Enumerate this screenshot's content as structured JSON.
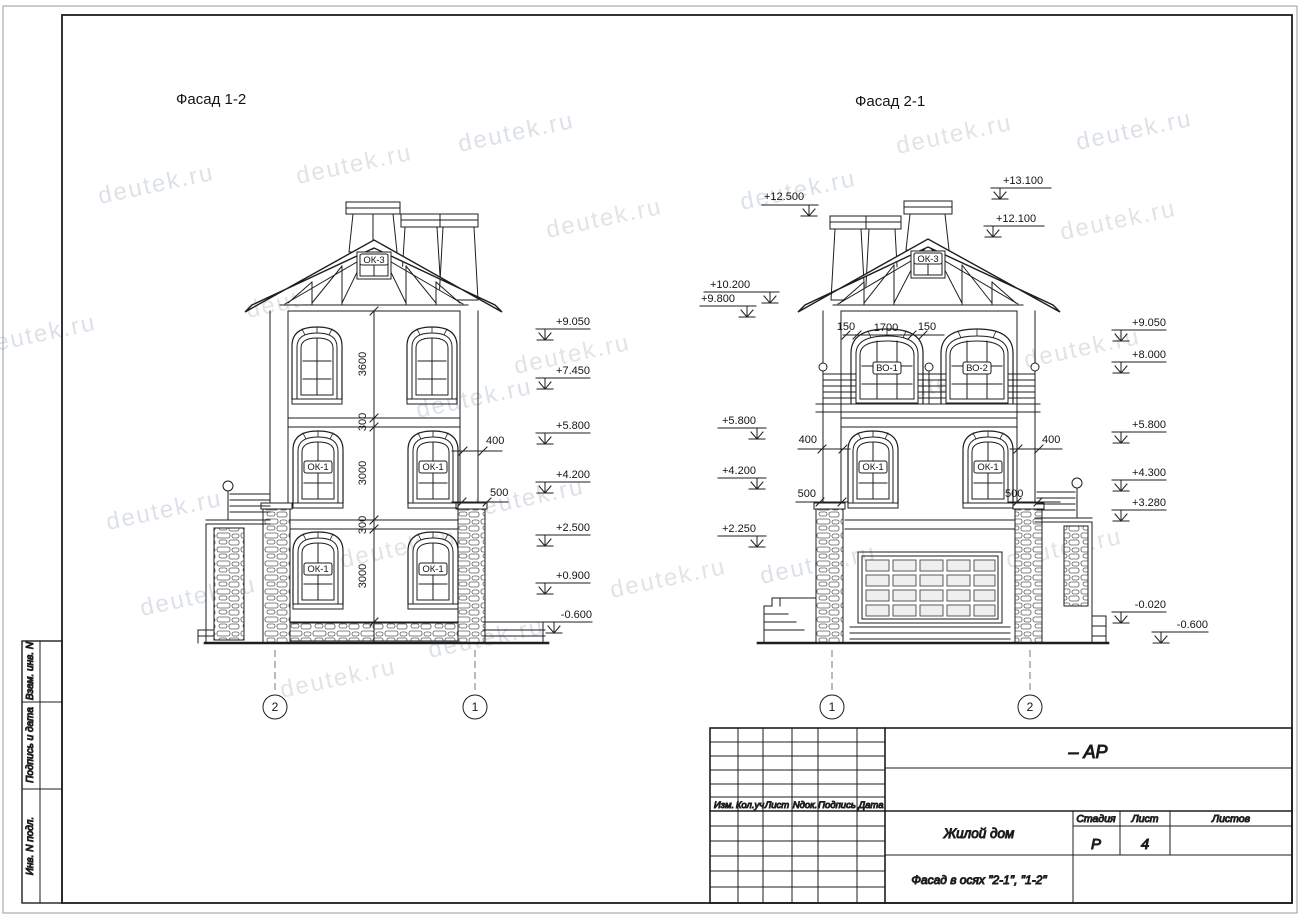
{
  "watermark": {
    "text": "deutek.ru"
  },
  "facades": {
    "left": {
      "title": "Фасад 1-2",
      "gable_window_label": "ОК-3",
      "window_labels": {
        "floor1_left": "ОК-1",
        "floor1_right": "ОК-1",
        "ground_left": "ОК-1",
        "ground_right": "ОК-1"
      },
      "elevations": [
        "+9.050",
        "+7.450",
        "+5.800",
        "+4.200",
        "+2.500",
        "+0.900",
        "-0.600"
      ],
      "vertical_dims": [
        "3600",
        "300",
        "3000",
        "300",
        "3000"
      ],
      "dim_400": "400",
      "dim_500": "500",
      "axis_left": "2",
      "axis_right": "1"
    },
    "right": {
      "title": "Фасад 2-1",
      "gable_window_label": "ОК-3",
      "window_labels": {
        "balcony_left": "ВО-1",
        "balcony_right": "ВО-2",
        "floor1_left": "ОК-1",
        "floor1_right": "ОК-1"
      },
      "elevations_top": [
        "+13.100",
        "+12.100"
      ],
      "elevations_left": [
        "+12.500",
        "+10.200",
        "+9.800",
        "+5.800",
        "+4.200",
        "+2.250"
      ],
      "elevations_right": [
        "+9.050",
        "+8.000",
        "+5.800",
        "+4.300",
        "+3.280",
        "-0.020",
        "-0.600"
      ],
      "top_dims": [
        "150",
        "1700",
        "150"
      ],
      "dim_400_left": "400",
      "dim_400_right": "400",
      "dim_500_left": "500",
      "dim_500_right": "500",
      "axis_left": "1",
      "axis_right": "2"
    }
  },
  "side_strip": {
    "labels": [
      "Взам. инв. N",
      "Подпись и дата",
      "Инв. N подл."
    ]
  },
  "title_block": {
    "doc_code": "– АР",
    "revision_headers": [
      "Изм.",
      "Кол.уч",
      "Лист",
      "Nдок.",
      "Подпись",
      "Дата"
    ],
    "project_name": "Жилой дом",
    "drawing_title": "Фасад в осях \"2-1\", \"1-2\"",
    "stage_label": "Стадия",
    "sheet_label": "Лист",
    "sheets_label": "Листов",
    "stage_value": "Р",
    "sheet_value": "4",
    "sheets_value": ""
  }
}
